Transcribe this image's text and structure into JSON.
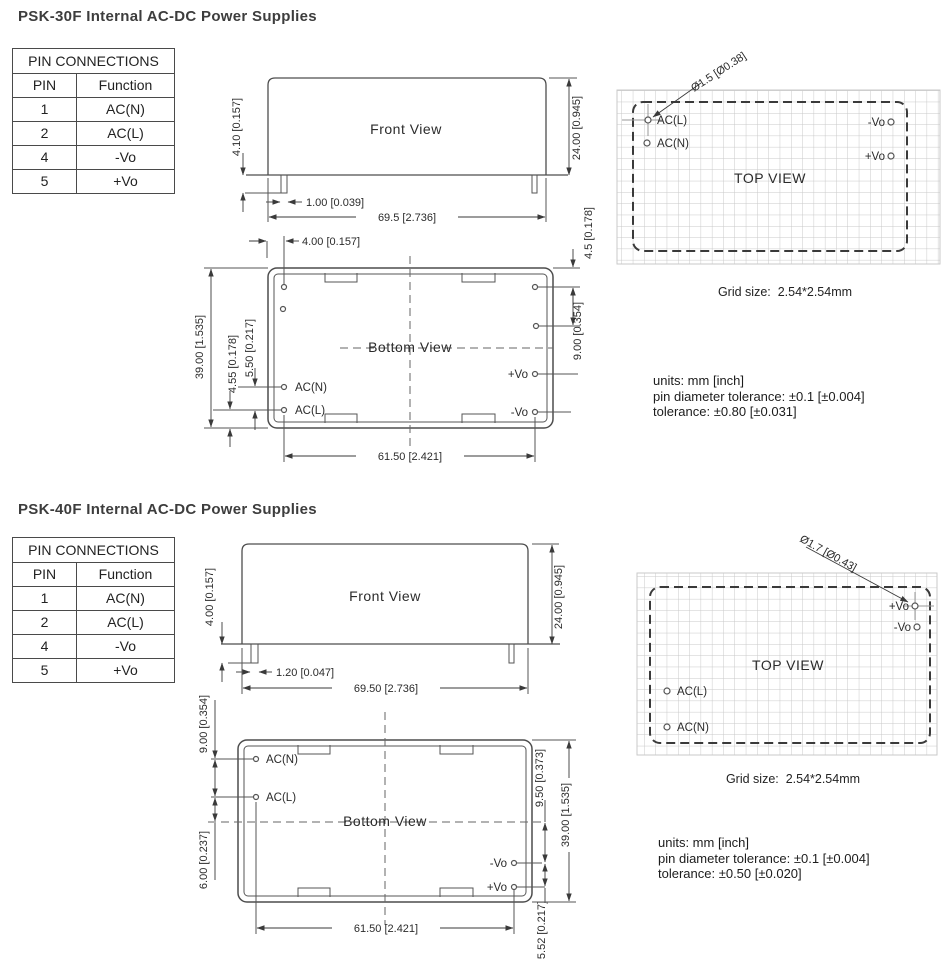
{
  "sections": [
    {
      "title": "PSK-30F Internal AC-DC Power Supplies",
      "table": {
        "title": "PIN CONNECTIONS",
        "col_pin": "PIN",
        "col_function": "Function",
        "rows": [
          [
            "1",
            "AC(N)"
          ],
          [
            "2",
            "AC(L)"
          ],
          [
            "4",
            "-Vo"
          ],
          [
            "5",
            "+Vo"
          ]
        ]
      },
      "front_view": {
        "label": "Front View",
        "dim_pin_length": "4.10 [0.157]",
        "dim_body_height": "24.00 [0.945]",
        "dim_pin_width": "1.00 [0.039]",
        "dim_body_width": "69.5 [2.736]"
      },
      "bottom_view": {
        "label": "Bottom View",
        "dim_pin_offset": "4.00 [0.157]",
        "dim_height": "39.00 [1.535]",
        "dim_left_a": "4.55 [0.178]",
        "dim_left_b": "5.50 [0.217]",
        "dim_right_a": "4.5 [0.178]",
        "dim_right_b": "9.00 [0.354]",
        "dim_pin_span": "61.50 [2.421]",
        "pin_acn": "AC(N)",
        "pin_acl": "AC(L)",
        "pin_pvo": "+Vo",
        "pin_nvo": "-Vo"
      },
      "top_view": {
        "label": "TOP VIEW",
        "pin_diameter": "Ø1.5 [Ø0.38]",
        "pin_acl": "AC(L)",
        "pin_acn": "AC(N)",
        "pin_nvo": "-Vo",
        "pin_pvo": "+Vo",
        "grid_caption": "Grid size:  2.54*2.54mm"
      },
      "notes": [
        "units: mm [inch]",
        "pin diameter tolerance: ±0.1 [±0.004]",
        "tolerance: ±0.80 [±0.031]"
      ]
    },
    {
      "title": "PSK-40F Internal AC-DC Power Supplies",
      "table": {
        "title": "PIN CONNECTIONS",
        "col_pin": "PIN",
        "col_function": "Function",
        "rows": [
          [
            "1",
            "AC(N)"
          ],
          [
            "2",
            "AC(L)"
          ],
          [
            "4",
            "-Vo"
          ],
          [
            "5",
            "+Vo"
          ]
        ]
      },
      "front_view": {
        "label": "Front View",
        "dim_pin_length": "4.00 [0.157]",
        "dim_body_height": "24.00 [0.945]",
        "dim_pin_width": "1.20 [0.047]",
        "dim_body_width": "69.50 [2.736]"
      },
      "bottom_view": {
        "label": "Bottom View",
        "dim_left_a": "9.00 [0.354]",
        "dim_left_b": "6.00 [0.237]",
        "dim_right_a": "9.50 [0.373]",
        "dim_right_b": "5.52 [0.217]",
        "dim_height": "39.00 [1.535]",
        "dim_pin_span": "61.50 [2.421]",
        "pin_acn": "AC(N)",
        "pin_acl": "AC(L)",
        "pin_pvo": "+Vo",
        "pin_nvo": "-Vo"
      },
      "top_view": {
        "label": "TOP VIEW",
        "pin_diameter": "Ø1.7 [Ø0.43]",
        "pin_acl": "AC(L)",
        "pin_acn": "AC(N)",
        "pin_nvo": "-Vo",
        "pin_pvo": "+Vo",
        "grid_caption": "Grid size:  2.54*2.54mm"
      },
      "notes": [
        "units: mm [inch]",
        "pin diameter tolerance: ±0.1 [±0.004]",
        "tolerance: ±0.50 [±0.020]"
      ]
    }
  ]
}
